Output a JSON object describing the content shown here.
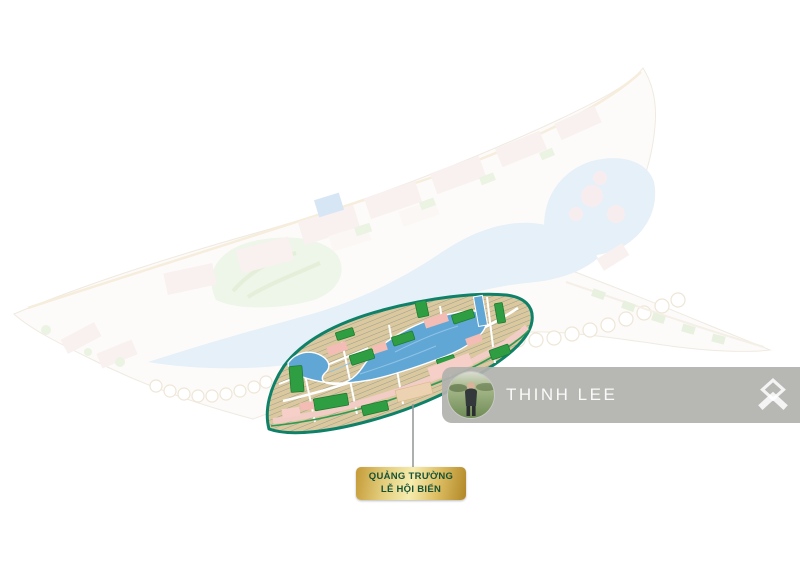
{
  "canvas": {
    "width": 800,
    "height": 566,
    "background": "#ffffff"
  },
  "callout": {
    "line1": "QUẢNG TRƯỜNG",
    "line2": "LỄ HỘI BIỂN",
    "text_color": "#155238",
    "gold_dark": "#b08727",
    "gold_light": "#f6ecae"
  },
  "watermark": {
    "name": "THINH LEE",
    "bar_color": "#b2b1ae",
    "text_color": "#ffffff"
  },
  "map": {
    "highlight_outline_color": "#0e8168",
    "lagoon_color": "#61a7d6",
    "park_color": "#2f9e43",
    "lot_color": "#dbc89e",
    "promenade_color": "#f1cdc6",
    "faded_water_color": "#c7dff0",
    "faded_land_color": "#fbf8f3",
    "golf_color": "#dcead0",
    "leader_line_color": "#8f9494"
  },
  "icons": {
    "logo": "double-chevron-diamond-logo",
    "avatar": "person-standing-in-field-photo"
  }
}
